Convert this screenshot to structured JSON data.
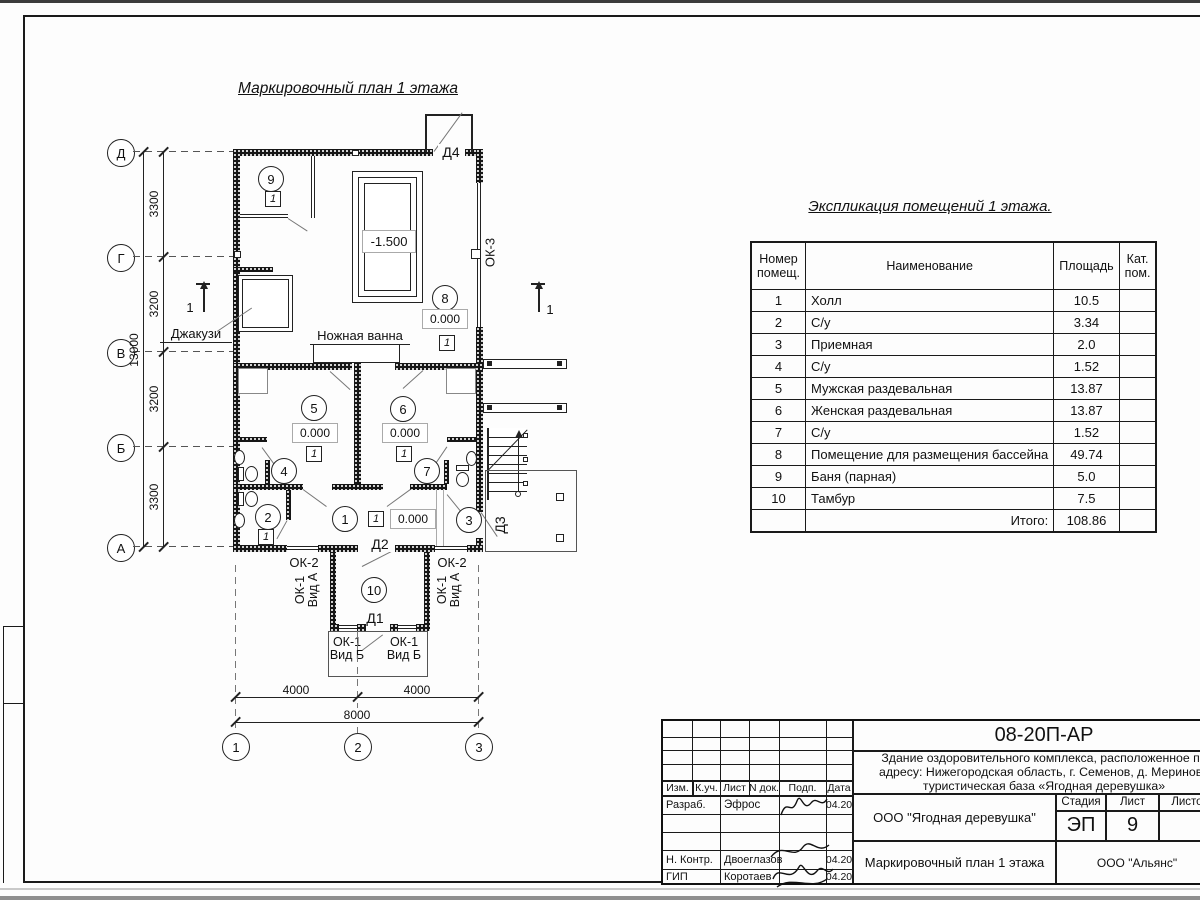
{
  "plan": {
    "title": "Маркировочный план 1 этажа",
    "axis_rows": [
      "Д",
      "Г",
      "В",
      "Б",
      "А"
    ],
    "axis_cols": [
      "1",
      "2",
      "3"
    ],
    "dim_segments_left": [
      "3300",
      "3200",
      "3200",
      "3300"
    ],
    "dim_total_left": "13000",
    "dim_segments_bottom": [
      "4000",
      "4000"
    ],
    "dim_total_bottom": "8000",
    "section_mark": "1",
    "room_numbers": [
      "1",
      "2",
      "3",
      "4",
      "5",
      "6",
      "7",
      "8",
      "9",
      "10"
    ],
    "floor_type": "1",
    "level_zero": "0.000",
    "level_pool": "-1.500",
    "labels": {
      "jacuzzi": "Джакузи",
      "foot_bath": "Ножная ванна",
      "d1": "Д1",
      "d2": "Д2",
      "d3": "Д3",
      "d4": "Д4",
      "ok2": "ОК-2",
      "ok3": "ОК-3",
      "ok1_vid_a": "ОК-1\nВид А",
      "ok1_vid_b": "ОК-1\nВид Б"
    }
  },
  "explication": {
    "title": "Экспликация помещений 1 этажа.",
    "col_num": "Номер\nпомещ.",
    "col_name": "Наименование",
    "col_area": "Площадь",
    "col_cat": "Кат.\nпом.",
    "rows": [
      [
        "1",
        "Холл",
        "10.5"
      ],
      [
        "2",
        "С/у",
        "3.34"
      ],
      [
        "3",
        "Приемная",
        "2.0"
      ],
      [
        "4",
        "С/у",
        "1.52"
      ],
      [
        "5",
        "Мужская раздевальная",
        "13.87"
      ],
      [
        "6",
        "Женская раздевальная",
        "13.87"
      ],
      [
        "7",
        "С/у",
        "1.52"
      ],
      [
        "8",
        "Помещение для размещения бассейна",
        "49.74"
      ],
      [
        "9",
        "Баня (парная)",
        "5.0"
      ],
      [
        "10",
        "Тамбур",
        "7.5"
      ]
    ],
    "total_label": "Итого:",
    "total_value": "108.86"
  },
  "titleblock": {
    "doc_number": "08-20П-АР",
    "description": "Здание оздоровительного комплекса, расположенное по\nадресу: Нижегородская область, г. Семенов, д. Мериново\nтуристическая база «Ягодная деревушка»",
    "cols": [
      "Изм.",
      "К.уч.",
      "Лист",
      "N док.",
      "Подп.",
      "Дата"
    ],
    "row_razrab_role": "Разраб.",
    "row_razrab_name": "Эфрос",
    "row_razrab_date": "04.20",
    "row_nkontr_role": "Н. Контр.",
    "row_nkontr_name": "Двоеглазов",
    "row_nkontr_date": "04.20",
    "row_gip_role": "ГИП",
    "row_gip_name": "Коротаев",
    "row_gip_date": "04.20",
    "company": "ООО \"Ягодная деревушка\"",
    "stage_label": "Стадия",
    "stage_value": "ЭП",
    "sheet_label": "Лист",
    "sheet_value": "9",
    "sheets_label": "Листов",
    "plan_name": "Маркировочный план 1 этажа",
    "contractor": "ООО \"Альянс\""
  }
}
